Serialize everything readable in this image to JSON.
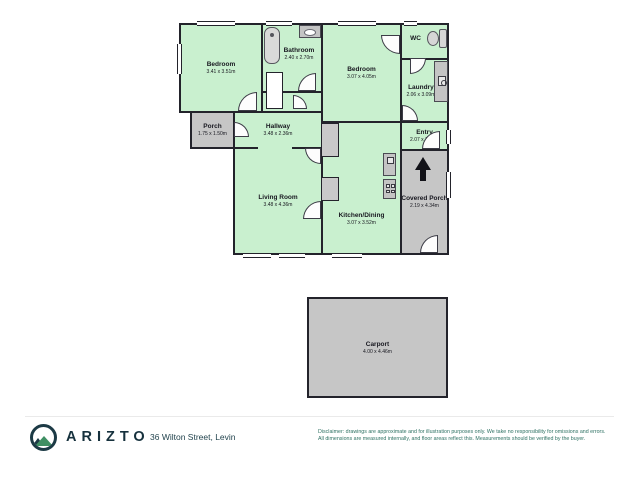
{
  "floorplan": {
    "rooms": {
      "bedroom1": {
        "name": "Bedroom",
        "dims": "3.41 x 3.51m"
      },
      "bathroom": {
        "name": "Bathroom",
        "dims": "2.40 x 2.70m"
      },
      "bedroom2": {
        "name": "Bedroom",
        "dims": "3.07 x 4.05m"
      },
      "wc": {
        "name": "WC",
        "dims": ""
      },
      "laundry": {
        "name": "Laundry",
        "dims": "2.06 x 3.09m"
      },
      "porch": {
        "name": "Porch",
        "dims": "1.75 x 1.50m"
      },
      "hallway": {
        "name": "Hallway",
        "dims": "3.48 x 2.36m"
      },
      "entry": {
        "name": "Entry",
        "dims": "2.07 x 1.07m"
      },
      "living": {
        "name": "Living Room",
        "dims": "3.48 x 4.36m"
      },
      "kitchen": {
        "name": "Kitchen/Dining",
        "dims": "3.07 x 3.52m"
      },
      "covered_porch": {
        "name": "Covered Porch",
        "dims": "2.19 x 4.34m"
      },
      "carport": {
        "name": "Carport",
        "dims": "4.00 x 4.46m"
      }
    },
    "icons": {
      "north_arrow": "up-arrow",
      "bathtub": "tub-shape",
      "toilet": "bowl-and-tank",
      "sink": "basin-oval",
      "washer": "square-with-circle",
      "fridge": "small-square",
      "stove": "four-burners"
    },
    "colors": {
      "room_fill": "#c9f0cf",
      "outdoor_fill": "#c6c6c6",
      "wall": "#23232b",
      "door_fill": "#fdfdfd"
    }
  },
  "footer": {
    "brand": "ARIZTO",
    "address": "36 Wilton Street, Levin",
    "disclaimer_line1": "Disclaimer: drawings are approximate and for illustration purposes only. We take no responsibility for omissions and errors.",
    "disclaimer_line2": "All dimensions are measured internally, and floor areas reflect this. Measurements should be verified by the buyer.",
    "brand_colors": {
      "ring": "#1c3a45",
      "mountain": "#3f8f63",
      "text": "#16313d",
      "disclaimer_text": "#2e7163"
    }
  }
}
